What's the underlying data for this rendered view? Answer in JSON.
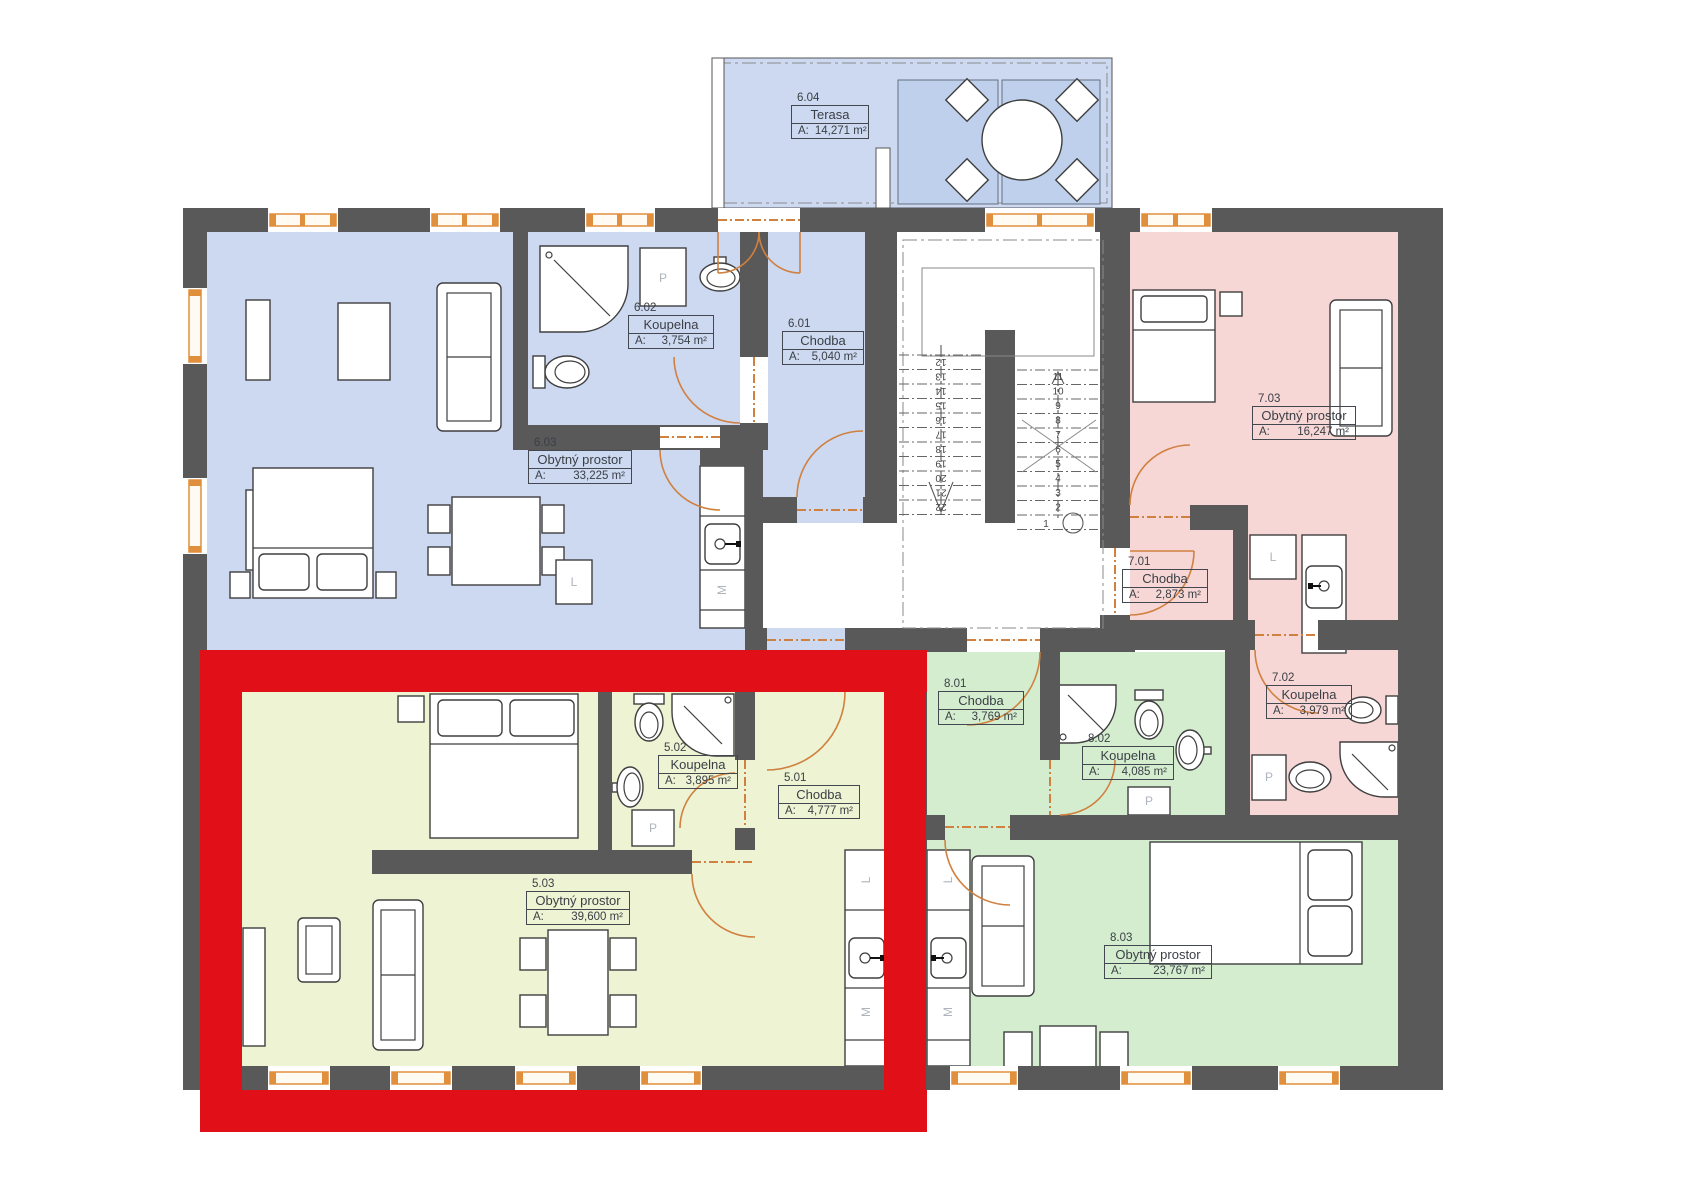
{
  "rooms": [
    {
      "id": "6.04",
      "name": "Terasa",
      "area_label": "A:",
      "area": "14,271 m²"
    },
    {
      "id": "6.02",
      "name": "Koupelna",
      "area_label": "A:",
      "area": "3,754 m²"
    },
    {
      "id": "6.01",
      "name": "Chodba",
      "area_label": "A:",
      "area": "5,040 m²"
    },
    {
      "id": "6.03",
      "name": "Obytný prostor",
      "area_label": "A:",
      "area": "33,225 m²"
    },
    {
      "id": "7.03",
      "name": "Obytný prostor",
      "area_label": "A:",
      "area": "16,247 m²"
    },
    {
      "id": "7.01",
      "name": "Chodba",
      "area_label": "A:",
      "area": "2,873 m²"
    },
    {
      "id": "7.02",
      "name": "Koupelna",
      "area_label": "A:",
      "area": "3,979 m²"
    },
    {
      "id": "8.01",
      "name": "Chodba",
      "area_label": "A:",
      "area": "3,769 m²"
    },
    {
      "id": "8.02",
      "name": "Koupelna",
      "area_label": "A:",
      "area": "4,085 m²"
    },
    {
      "id": "8.03",
      "name": "Obytný prostor",
      "area_label": "A:",
      "area": "23,767 m²"
    },
    {
      "id": "5.02",
      "name": "Koupelna",
      "area_label": "A:",
      "area": "3,895 m²"
    },
    {
      "id": "5.01",
      "name": "Chodba",
      "area_label": "A:",
      "area": "4,777 m²"
    },
    {
      "id": "5.03",
      "name": "Obytný prostor",
      "area_label": "A:",
      "area": "39,600 m²"
    }
  ],
  "appliances": {
    "washer": "P",
    "fridge": "L",
    "dishwasher": "M"
  },
  "stairs": {
    "left_flight": [
      "12",
      "13",
      "14",
      "15",
      "16",
      "17",
      "18",
      "19",
      "20",
      "21",
      "22"
    ],
    "right_flight": [
      "11",
      "10",
      "9",
      "8",
      "7",
      "6",
      "5",
      "4",
      "3",
      "2"
    ],
    "first_step": "1"
  },
  "colors": {
    "wall": "#595959",
    "apartment_5": "#edf3d3",
    "apartment_6": "#cdd9f1",
    "apartment_7": "#f7d6d6",
    "apartment_8": "#d4edcf",
    "glass": "#bfd0ec",
    "highlight": "#e11018",
    "door": "#d0803f",
    "window_frame": "#e08f3c"
  }
}
